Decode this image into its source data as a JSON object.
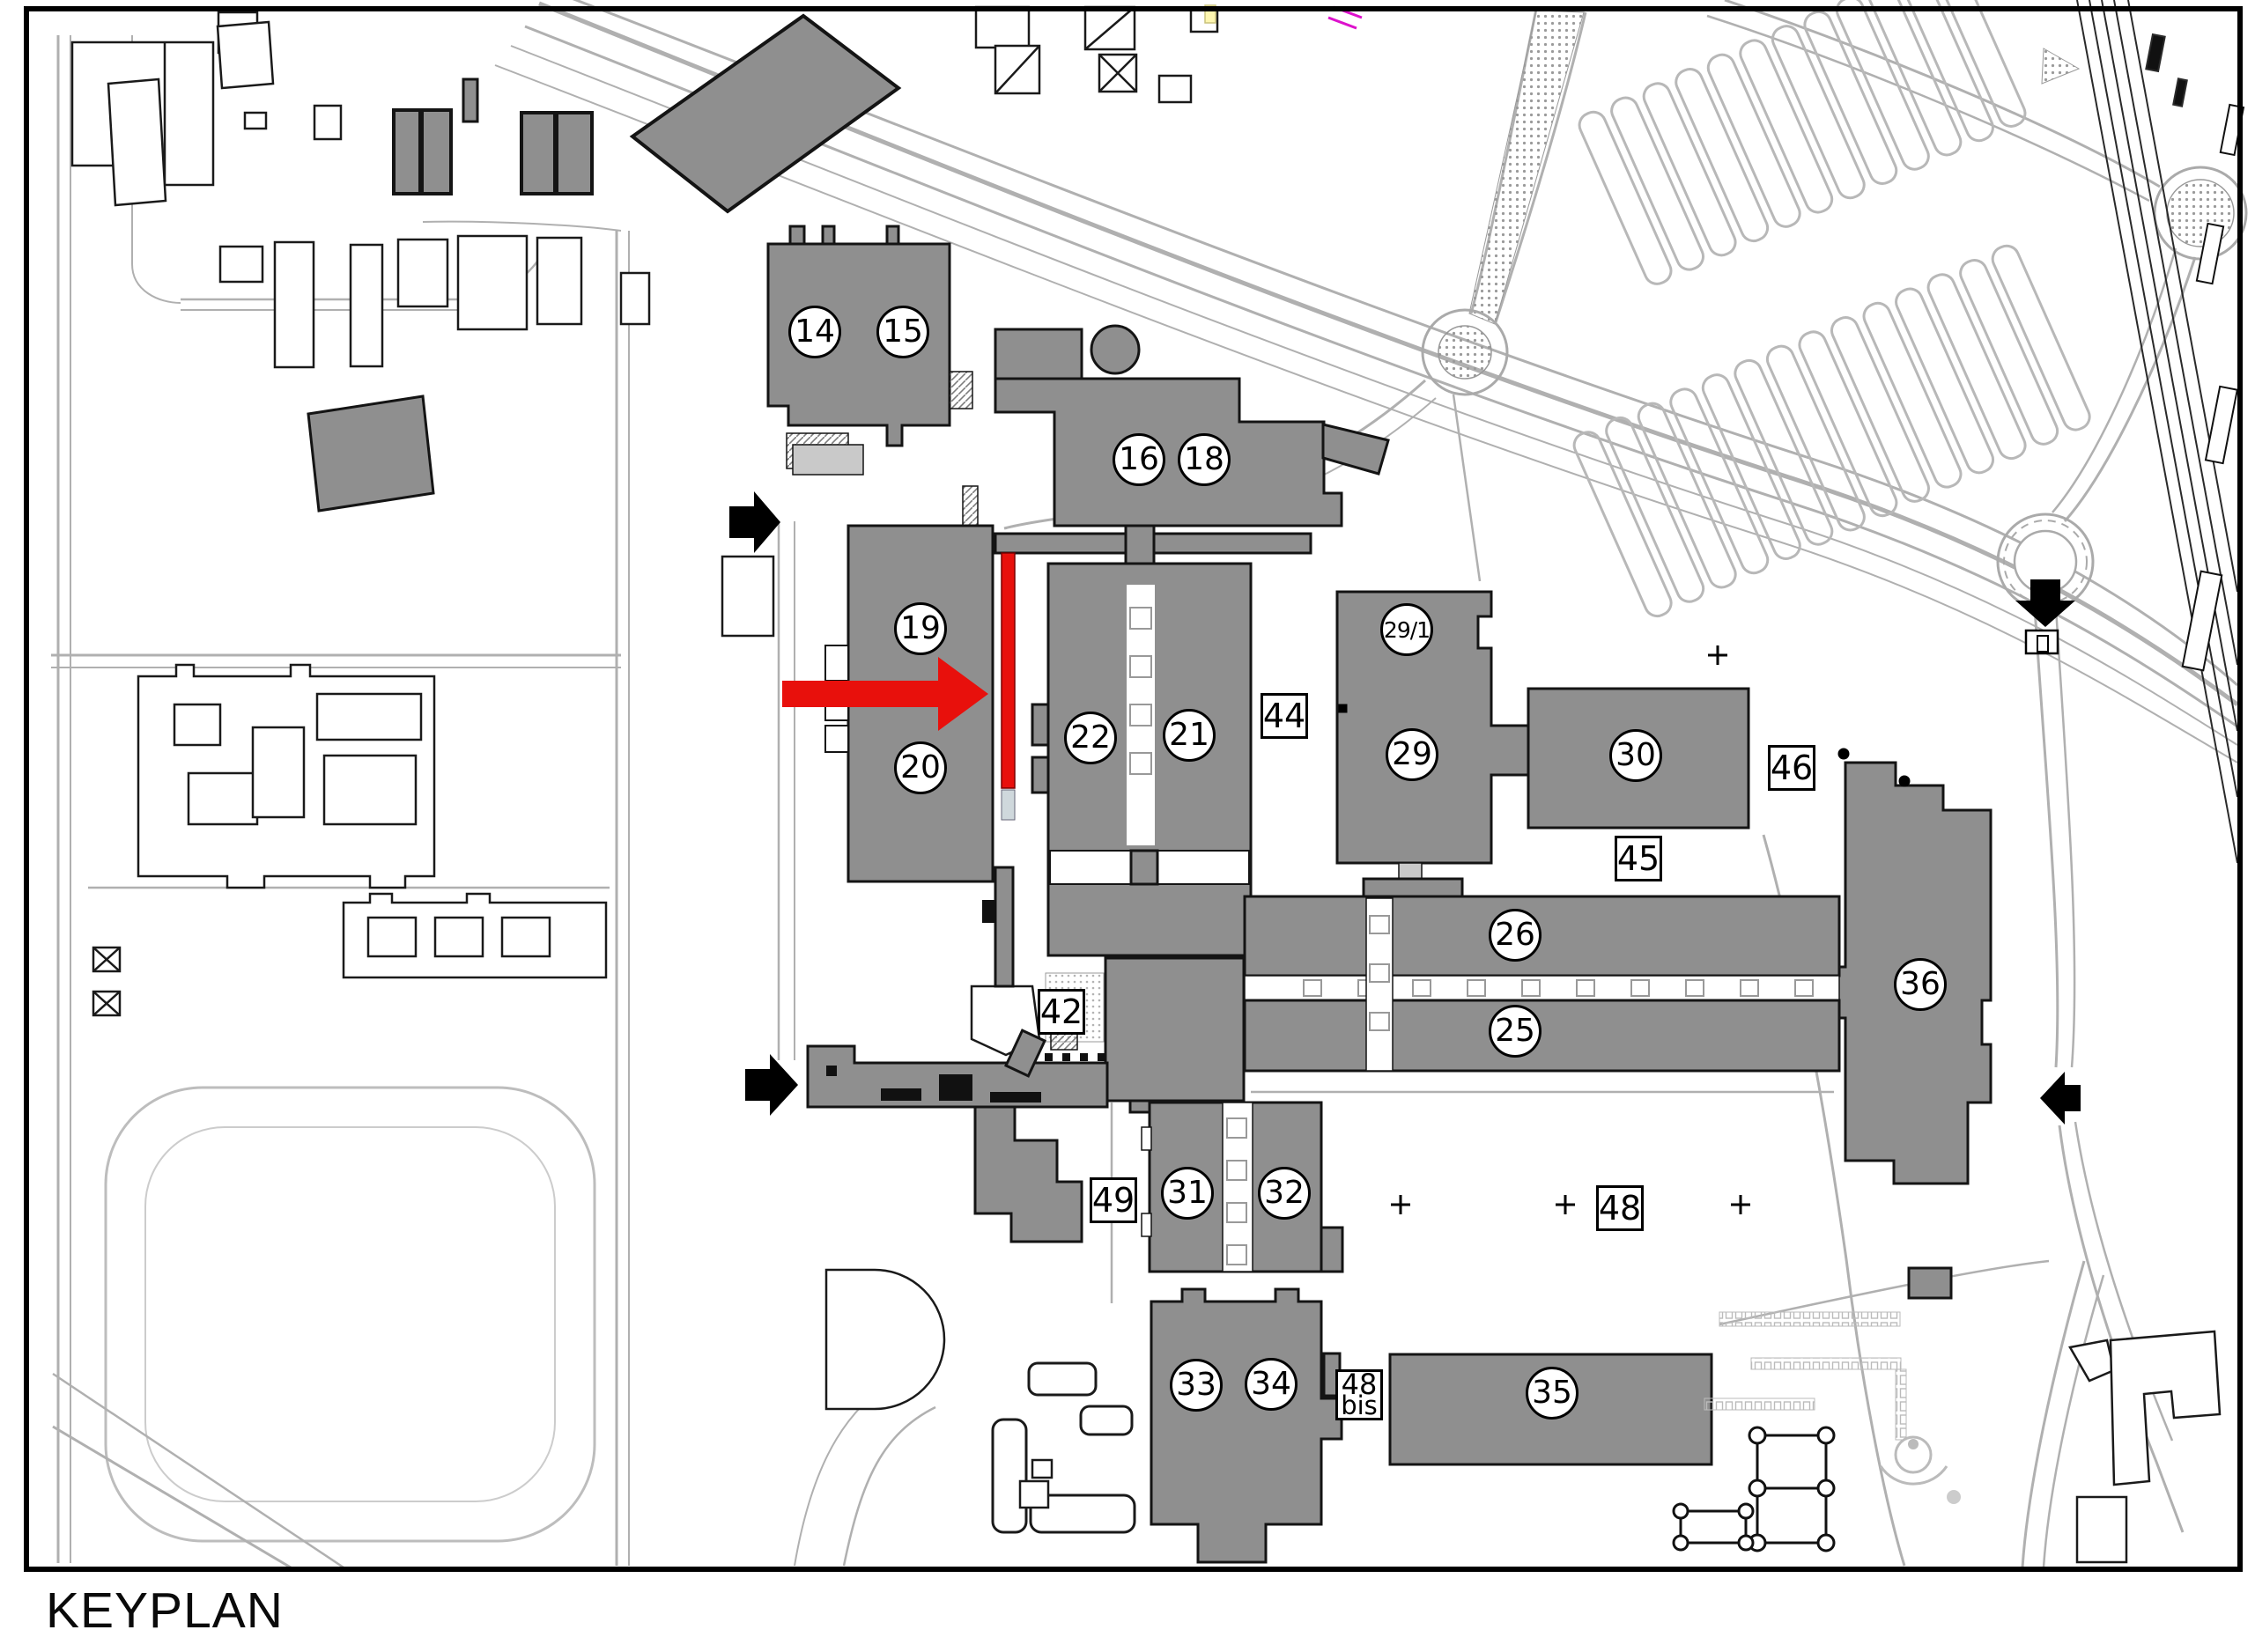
{
  "title": "KEYPLAN",
  "colors": {
    "building_gray": "#8f8f8f",
    "outline_black": "#141414",
    "highlight_red": "#e8100c",
    "road_gray": "#b5b5b5",
    "frame_black": "#000000"
  },
  "labels": {
    "circles": [
      {
        "text": "14"
      },
      {
        "text": "15"
      },
      {
        "text": "16"
      },
      {
        "text": "18"
      },
      {
        "text": "19"
      },
      {
        "text": "20"
      },
      {
        "text": "22"
      },
      {
        "text": "21"
      },
      {
        "text": "29/1"
      },
      {
        "text": "29"
      },
      {
        "text": "30"
      },
      {
        "text": "36"
      },
      {
        "text": "26"
      },
      {
        "text": "25"
      },
      {
        "text": "31"
      },
      {
        "text": "32"
      },
      {
        "text": "33"
      },
      {
        "text": "34"
      },
      {
        "text": "35"
      }
    ],
    "boxes": [
      {
        "text": "44"
      },
      {
        "text": "45"
      },
      {
        "text": "46"
      },
      {
        "text": "42"
      },
      {
        "text": "49"
      },
      {
        "text": "48"
      }
    ],
    "box_two_line": {
      "line1": "48",
      "line2": "bis"
    }
  }
}
